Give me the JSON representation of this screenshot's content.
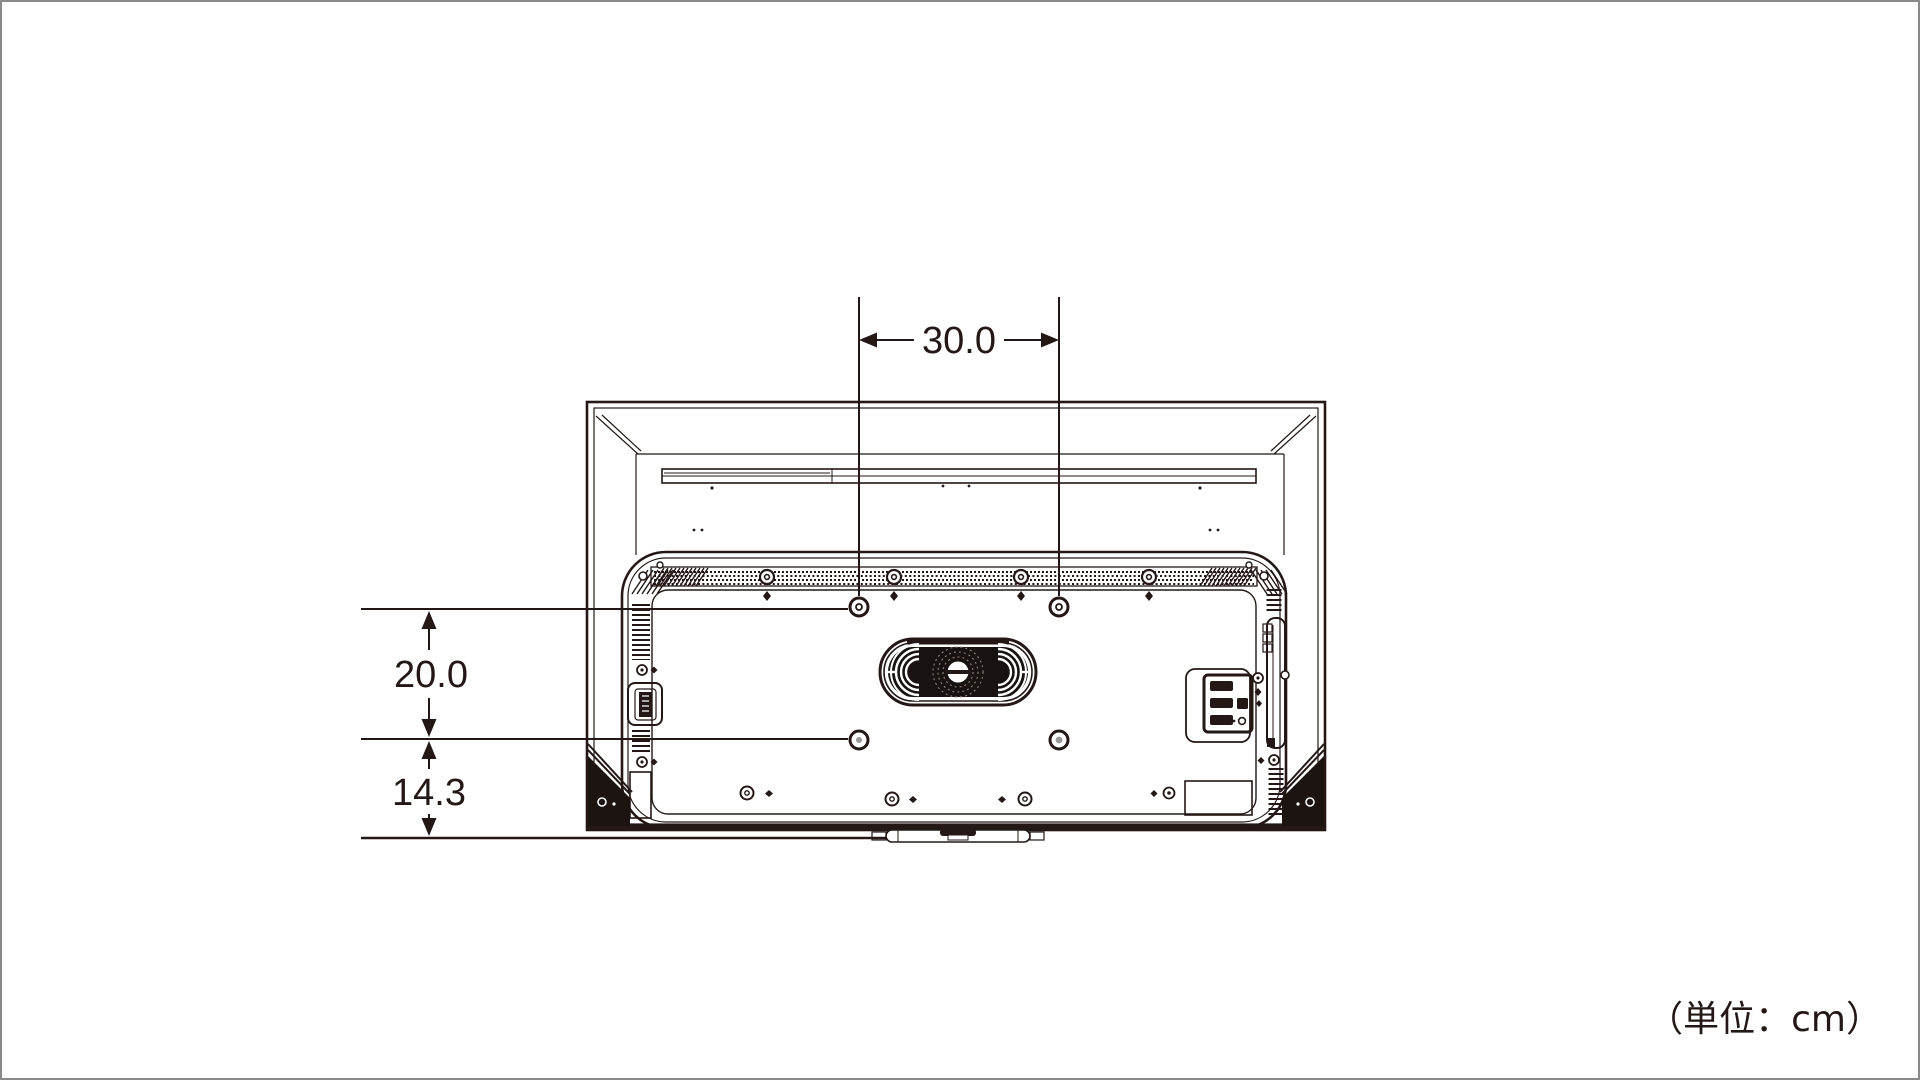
{
  "diagram": {
    "unit_note": "（単位：cm）",
    "dimensions": {
      "vesa_horizontal": "30.0",
      "vesa_vertical": "20.0",
      "bottom_offset": "14.3"
    },
    "colors": {
      "line": "#231815",
      "background": "#ffffff",
      "page_border": "#8a8a8a"
    }
  }
}
